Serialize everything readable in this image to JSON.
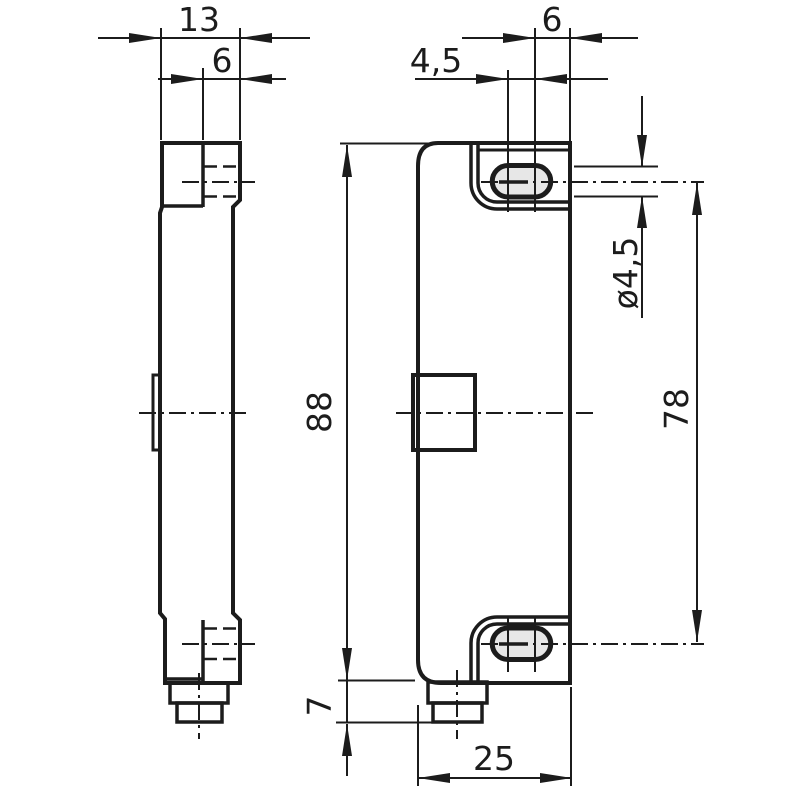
{
  "drawing": {
    "type": "technical-dimension-drawing",
    "colors": {
      "background": "#ffffff",
      "line": "#1c1c1c",
      "slot_fill": "#e7e7e7"
    },
    "dimensions": {
      "depth_total": "13",
      "flange_thickness": "6",
      "slot_center_to_edge": "6",
      "slot_center_spacing": "4,5",
      "body_height": "88",
      "connector_height": "7",
      "body_width": "25",
      "slot_width_diameter": "ø4,5",
      "hole_center_distance": "78"
    }
  }
}
